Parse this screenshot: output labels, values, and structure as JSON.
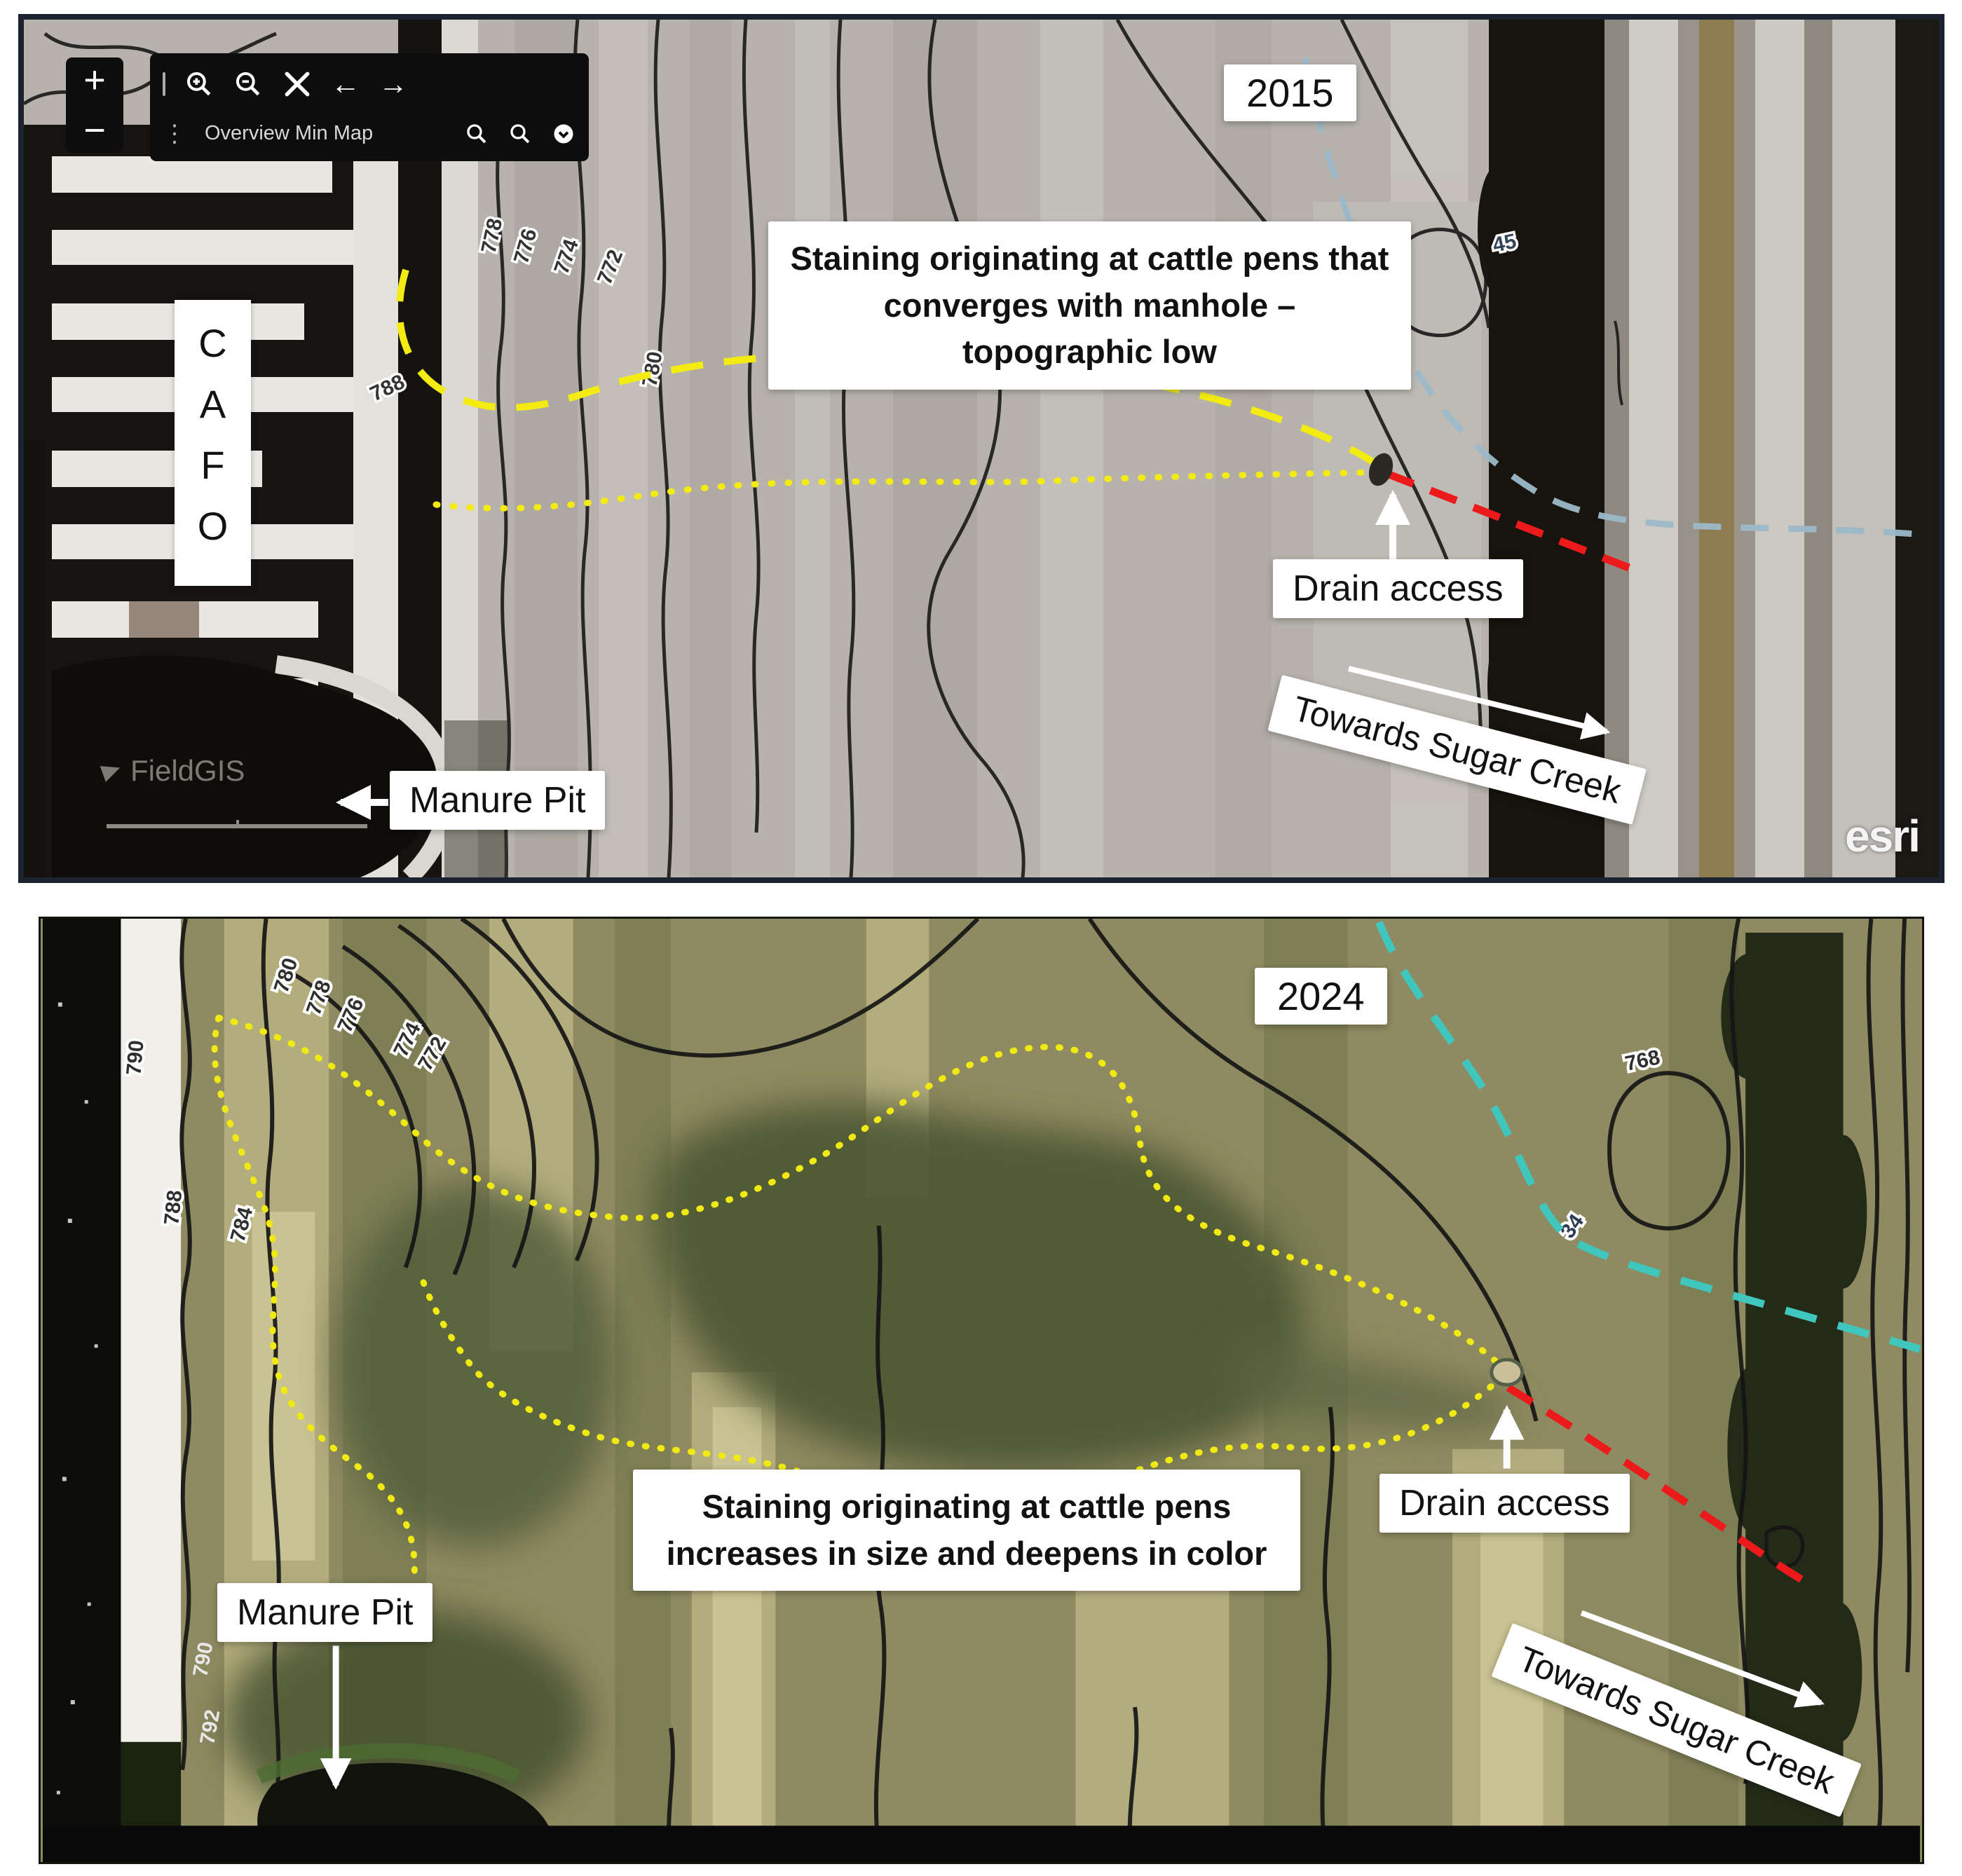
{
  "colors": {
    "annotation_yellow": "#f3eb11",
    "annotation_red": "#ec1a1a",
    "tile_line_2015": "#9cb8c8",
    "tile_line_2024": "#3fc6bd",
    "label_box_bg": "#ffffff",
    "label_text": "#111111",
    "panel_border": "#1b2230"
  },
  "panel_2015": {
    "year": "2015",
    "cafo": "CAFO",
    "note": "Staining originating at cattle pens that converges with manhole – topographic low",
    "drain": "Drain access",
    "creek": "Towards Sugar Creek",
    "manure": "Manure Pit",
    "fieldgis_watermark": "FieldGIS",
    "esri_watermark": "esri",
    "toolbar": {
      "zoom_in": "+",
      "zoom_out": "−",
      "kebab": "⋮",
      "overview_label": "Overview Min Map",
      "arrow_left": "←",
      "arrow_right": "→"
    },
    "contour_labels": [
      "778",
      "776",
      "774",
      "772",
      "788",
      "780"
    ],
    "tile_label": "45"
  },
  "panel_2024": {
    "year": "2024",
    "note": "Staining originating at cattle pens increases in size and deepens in color",
    "drain": "Drain access",
    "creek": "Towards Sugar Creek",
    "manure": "Manure Pit",
    "contour_labels": [
      "780",
      "778",
      "776",
      "774",
      "772",
      "790",
      "788",
      "784",
      "768",
      "790",
      "792"
    ],
    "tile_label": "34"
  }
}
